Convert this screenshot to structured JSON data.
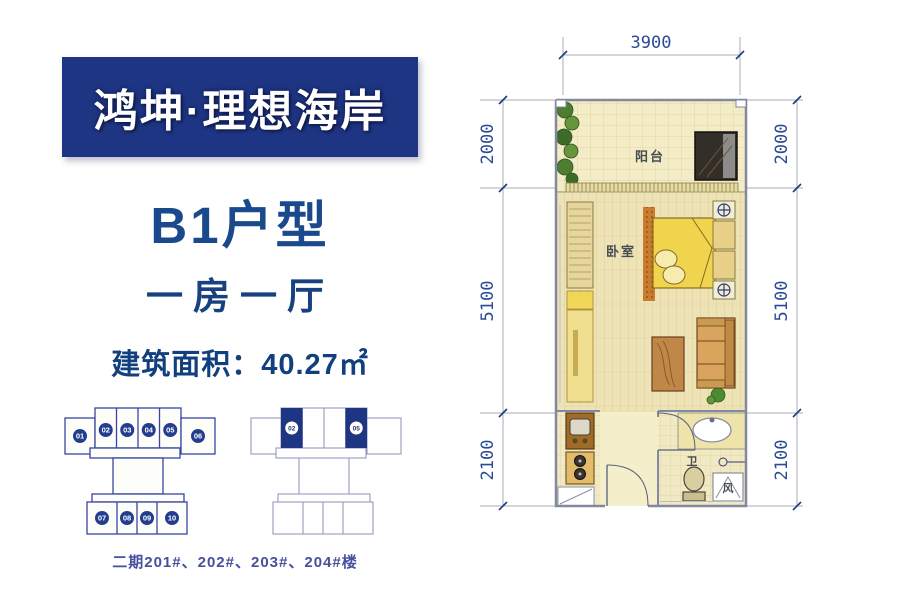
{
  "left_panel": {
    "brand": "鸿坤·理想海岸",
    "unit_type": "B1户型",
    "layout_desc": "一房一厅",
    "area_label": "建筑面积：40.27㎡",
    "buildings_caption": "二期201#、202#、203#、204#楼",
    "diagram_left": {
      "units_top": [
        "01",
        "02",
        "03",
        "04",
        "05",
        "06"
      ],
      "units_bottom": [
        "07",
        "08",
        "09",
        "10"
      ]
    },
    "diagram_right": {
      "highlighted_units": [
        "02",
        "05"
      ]
    }
  },
  "floor_plan": {
    "dim_top": "3900",
    "dim_left": [
      "2000",
      "5100",
      "2100"
    ],
    "dim_right": [
      "2000",
      "5100",
      "2100"
    ],
    "labels": {
      "balcony": "阳台",
      "bedroom": "卧室",
      "bath": "卫",
      "vent": "风"
    }
  },
  "colors": {
    "banner_navy": "#1e3583",
    "heading_navy": "#1a4a8c",
    "highlight_navy": "#1e3583",
    "dimension_navy": "#2a4b93",
    "floor_yellow": "#f1e9c4"
  }
}
